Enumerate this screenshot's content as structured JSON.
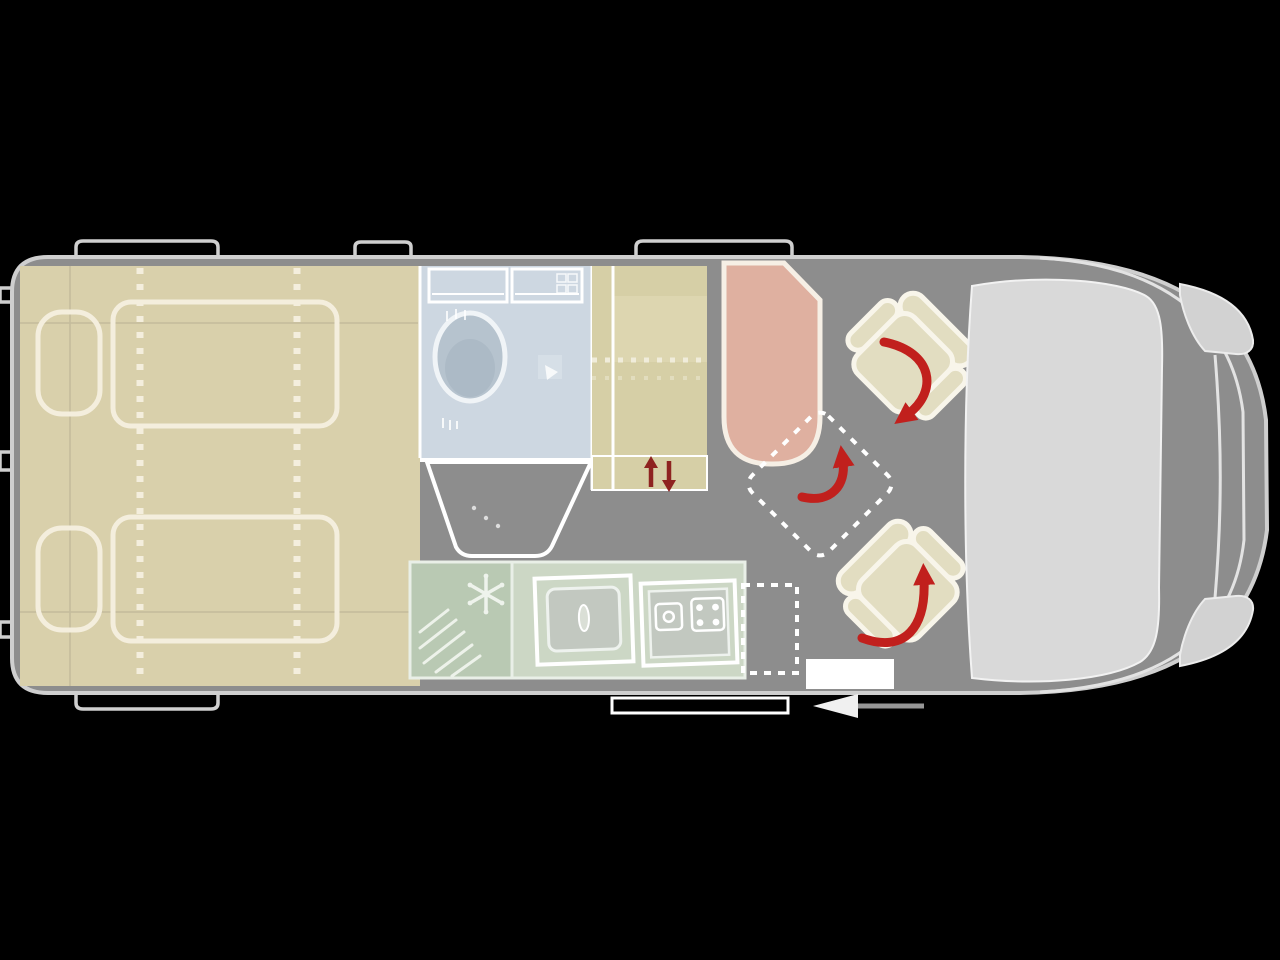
{
  "palette": {
    "background": "#000000",
    "floor": "#8d8d8d",
    "outline": "#cfcfcf",
    "furniture_stroke": "#f4eedd",
    "bed_area": "#d9d0ab",
    "bathroom": "#cdd7e1",
    "shower_tray": "#d3dde5",
    "fixture": "#b6c3ce",
    "wardrobe": "#d6cfa6",
    "wardrobe_strip": "#ece7d8",
    "fridge": "#b9c9b3",
    "counter": "#ccd7c5",
    "appliance": "#c2c8c0",
    "flap": "#d4dbd0",
    "bench_seat": "#dfb0a0",
    "table": "#e9cbbf",
    "swivel_seat": "#e2ddc1",
    "dashboard": "#d9d9d9",
    "headlight": "#d2d2d2",
    "arrow_red": "#c1201d",
    "entry_arrow_red": "#8e2320",
    "step": "#ffffff"
  },
  "zones": [
    {
      "id": "rear-bedroom",
      "name": "rear twin beds"
    },
    {
      "id": "bathroom",
      "name": "bathroom with toilet and shower"
    },
    {
      "id": "wardrobe",
      "name": "wardrobe"
    },
    {
      "id": "kitchen",
      "name": "kitchen with fridge, sink and stove"
    },
    {
      "id": "lounge",
      "name": "lounge with bench, table position and swivel seats"
    },
    {
      "id": "cab",
      "name": "driver cab with dashboard"
    }
  ],
  "icons": [
    "snowflake-icon",
    "rotation-arrow-icon",
    "entry-arrows-icon",
    "slide-door-arrow-icon",
    "shower-head-icon"
  ]
}
